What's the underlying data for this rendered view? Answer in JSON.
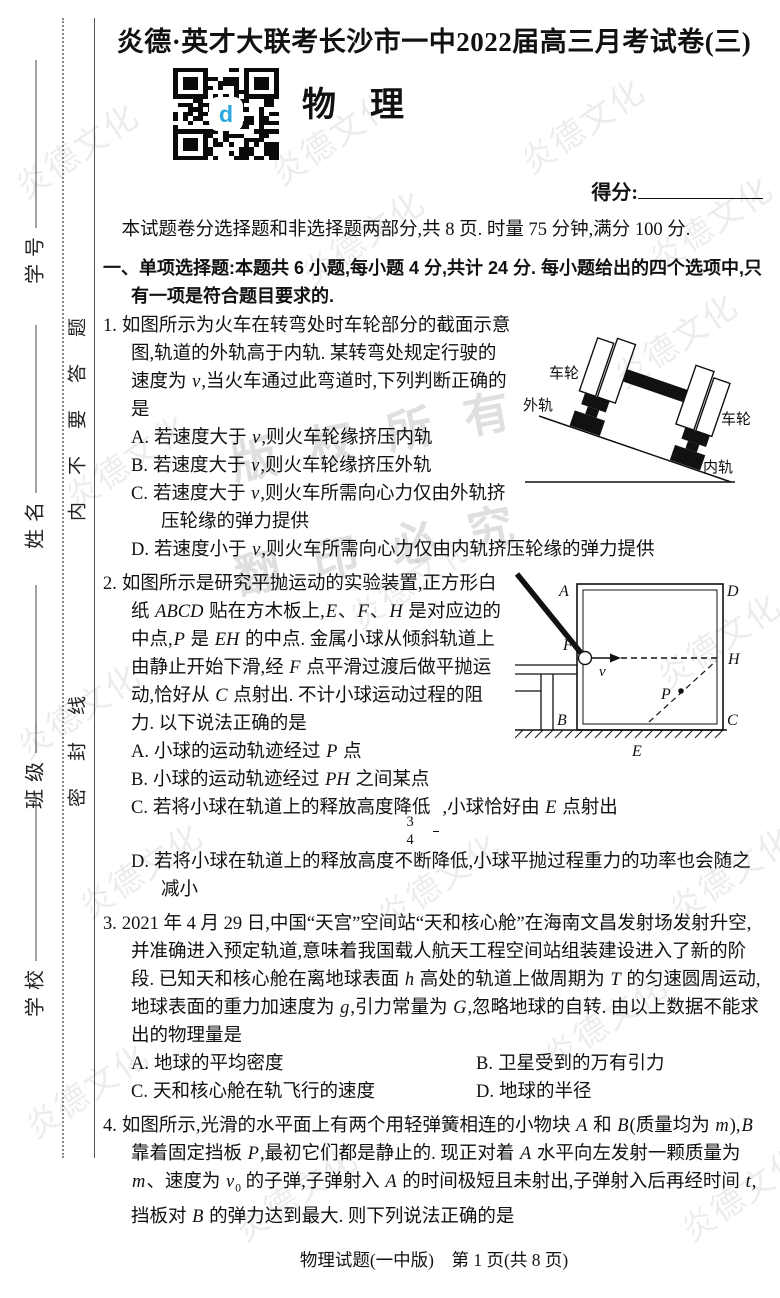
{
  "page": {
    "title": "炎德·英才大联考长沙市一中2022届高三月考试卷(三)",
    "subject": "物　理",
    "qr_logo": "d",
    "score_label": "得分:",
    "intro": "本试题卷分选择题和非选择题两部分,共 8 页. 时量 75 分钟,满分 100 分.",
    "footer": "物理试题(一中版)　第 1 页(共 8 页)"
  },
  "sidebar": {
    "fields": [
      {
        "label": "学号"
      },
      {
        "label": "姓名"
      },
      {
        "label": "班级"
      },
      {
        "label": "学校"
      }
    ],
    "seal_text_upper": "内不要答题",
    "seal_text_lower": "密封线"
  },
  "watermarks": {
    "brand": "炎德文化",
    "copyright": [
      "版权所有",
      "翻印必究"
    ],
    "items": [
      {
        "x": 6,
        "y": 125
      },
      {
        "x": 262,
        "y": 112
      },
      {
        "x": 512,
        "y": 100
      },
      {
        "x": 292,
        "y": 212
      },
      {
        "x": 640,
        "y": 198
      },
      {
        "x": 56,
        "y": 436
      },
      {
        "x": 605,
        "y": 315
      },
      {
        "x": 340,
        "y": 556
      },
      {
        "x": 648,
        "y": 615
      },
      {
        "x": 8,
        "y": 685
      },
      {
        "x": 70,
        "y": 845
      },
      {
        "x": 368,
        "y": 855
      },
      {
        "x": 660,
        "y": 848
      },
      {
        "x": 16,
        "y": 1065
      },
      {
        "x": 535,
        "y": 995
      },
      {
        "x": 225,
        "y": 1168
      },
      {
        "x": 672,
        "y": 1168
      }
    ]
  },
  "section1": {
    "heading": [
      {
        "t": "一、单项选择题:本题共 6 小题,每小题 4 分,共计 24 分. 每小题给出的四个选项中,只有一项是符合题目要求的."
      }
    ]
  },
  "questions": [
    {
      "number": "1.",
      "stem": [
        {
          "t": "如图所示为火车在转弯处时车轮部分的截面示意图,轨道的外轨高于内轨. 某转弯处规定行驶的速度为 "
        },
        {
          "i": "v"
        },
        {
          "t": ",当火车通过此弯道时,下列判断正确的是"
        }
      ],
      "options": [
        {
          "label": "A.",
          "text": [
            {
              "t": "若速度大于 "
            },
            {
              "i": "v"
            },
            {
              "t": ",则火车轮缘挤压内轨"
            }
          ]
        },
        {
          "label": "B.",
          "text": [
            {
              "t": "若速度大于 "
            },
            {
              "i": "v"
            },
            {
              "t": ",则火车轮缘挤压外轨"
            }
          ]
        },
        {
          "label": "C.",
          "text": [
            {
              "t": "若速度大于 "
            },
            {
              "i": "v"
            },
            {
              "t": ",则火车所需向心力仅由外轨挤压轮缘的弹力提供"
            }
          ]
        },
        {
          "label": "D.",
          "text": [
            {
              "t": "若速度小于 "
            },
            {
              "i": "v"
            },
            {
              "t": ",则火车所需向心力仅由内轨挤压轮缘的弹力提供"
            }
          ]
        }
      ],
      "figure": {
        "labels": {
          "wheel_top": "车轮",
          "outer_rail": "外轨",
          "wheel_right": "车轮",
          "inner_rail": "内轨"
        }
      }
    },
    {
      "number": "2.",
      "stem": [
        {
          "t": "如图所示是研究平抛运动的实验装置,正方形白纸 "
        },
        {
          "i": "ABCD"
        },
        {
          "t": " 贴在方木板上,"
        },
        {
          "i": "E"
        },
        {
          "t": "、"
        },
        {
          "i": "F"
        },
        {
          "t": "、"
        },
        {
          "i": "H"
        },
        {
          "t": " 是对应边的中点,"
        },
        {
          "i": "P"
        },
        {
          "t": " 是 "
        },
        {
          "i": "EH"
        },
        {
          "t": " 的中点. 金属小球从倾斜轨道上由静止开始下滑,经 "
        },
        {
          "i": "F"
        },
        {
          "t": " 点平滑过渡后做平抛运动,恰好从 "
        },
        {
          "i": "C"
        },
        {
          "t": " 点射出. 不计小球运动过程的阻力. 以下说法正确的是"
        }
      ],
      "options": [
        {
          "label": "A.",
          "text": [
            {
              "t": "小球的运动轨迹经过 "
            },
            {
              "i": "P"
            },
            {
              "t": " 点"
            }
          ]
        },
        {
          "label": "B.",
          "text": [
            {
              "t": "小球的运动轨迹经过 "
            },
            {
              "i": "PH"
            },
            {
              "t": " 之间某点"
            }
          ]
        },
        {
          "label": "C.",
          "text": [
            {
              "t": "若将小球在轨道上的释放高度降低"
            },
            {
              "frac": [
                "3",
                "4"
              ]
            },
            {
              "t": ",小球恰好由 "
            },
            {
              "i": "E"
            },
            {
              "t": " 点射出"
            }
          ]
        },
        {
          "label": "D.",
          "text": [
            {
              "t": "若将小球在轨道上的释放高度不断降低,小球平抛过程重力的功率也会随之减小"
            }
          ]
        }
      ],
      "figure": {
        "labels": {
          "a": "A",
          "b": "B",
          "c": "C",
          "d": "D",
          "e": "E",
          "f": "F",
          "h": "H",
          "p": "P",
          "v": "v"
        }
      }
    },
    {
      "number": "3.",
      "stem": [
        {
          "t": "2021 年 4 月 29 日,中国“天宫”空间站“天和核心舱”在海南文昌发射场发射升空,并准确进入预定轨道,意味着我国载人航天工程空间站组装建设进入了新的阶段. 已知天和核心舱在离地球表面 "
        },
        {
          "i": "h"
        },
        {
          "t": " 高处的轨道上做周期为 "
        },
        {
          "i": "T"
        },
        {
          "t": " 的匀速圆周运动,地球表面的重力加速度为 "
        },
        {
          "i": "g"
        },
        {
          "t": ",引力常量为 "
        },
        {
          "i": "G"
        },
        {
          "t": ",忽略地球的自转. 由以上数据不能求出的物理量是"
        }
      ],
      "options": [
        {
          "label": "A.",
          "text": [
            {
              "t": "地球的平均密度"
            }
          ]
        },
        {
          "label": "B.",
          "text": [
            {
              "t": "卫星受到的万有引力"
            }
          ]
        },
        {
          "label": "C.",
          "text": [
            {
              "t": "天和核心舱在轨飞行的速度"
            }
          ]
        },
        {
          "label": "D.",
          "text": [
            {
              "t": "地球的半径"
            }
          ]
        }
      ]
    },
    {
      "number": "4.",
      "stem": [
        {
          "t": "如图所示,光滑的水平面上有两个用轻弹簧相连的小物块 "
        },
        {
          "i": "A"
        },
        {
          "t": " 和 "
        },
        {
          "i": "B"
        },
        {
          "t": "(质量均为 "
        },
        {
          "i": "m"
        },
        {
          "t": "),"
        },
        {
          "i": "B"
        },
        {
          "t": " 靠着固定挡板 "
        },
        {
          "i": "P"
        },
        {
          "t": ",最初它们都是静止的. 现正对着 "
        },
        {
          "i": "A"
        },
        {
          "t": " 水平向左发射一颗质量为 "
        },
        {
          "i": "m"
        },
        {
          "t": "、速度为 "
        },
        {
          "i": "v",
          "sub": "0"
        },
        {
          "t": " 的子弹,子弹射入 "
        },
        {
          "i": "A"
        },
        {
          "t": " 的时间极短且未射出,子弹射入后再经时间 "
        },
        {
          "i": "t"
        },
        {
          "t": ",挡板对 "
        },
        {
          "i": "B"
        },
        {
          "t": " 的弹力达到最大. 则下列说法正确的是"
        }
      ]
    }
  ]
}
